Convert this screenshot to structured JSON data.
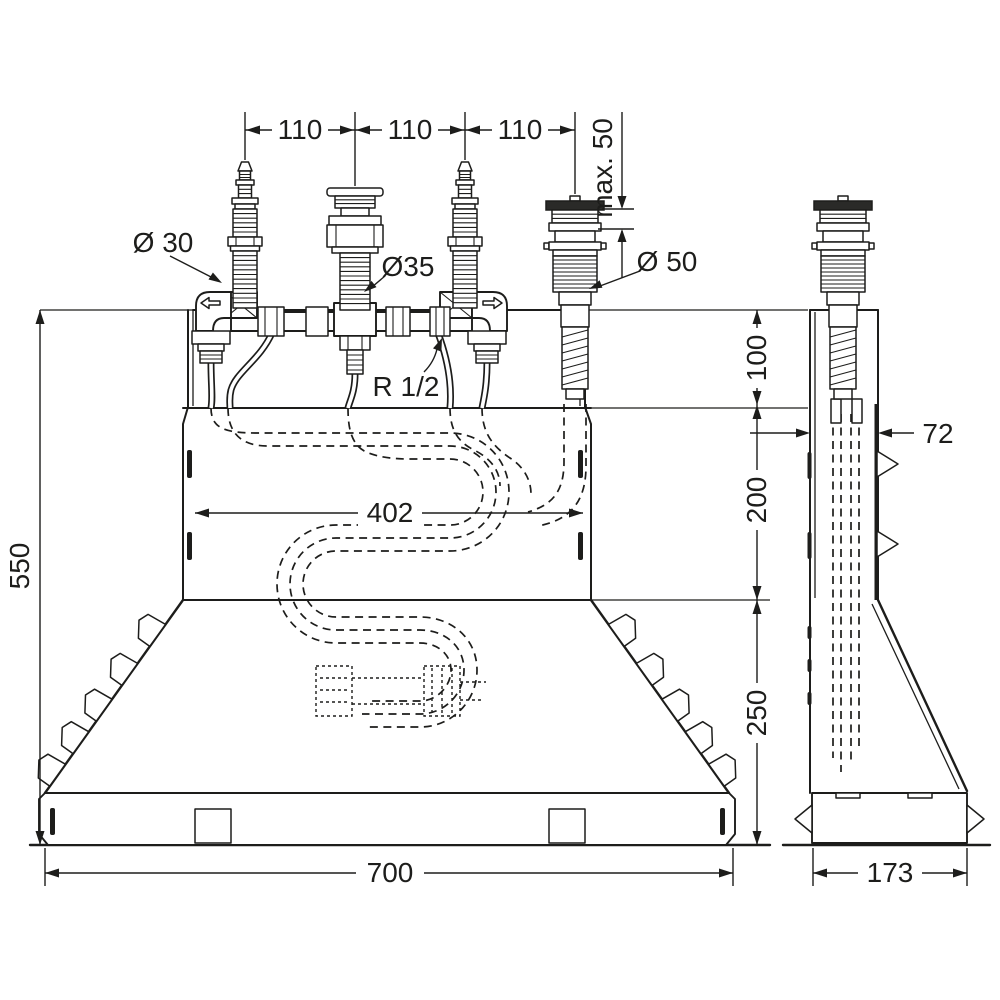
{
  "drawing": {
    "line_color": "#1d1d1b",
    "background_color": "#ffffff",
    "dims": {
      "spacing_1": "110",
      "spacing_2": "110",
      "spacing_3": "110",
      "max_mount_depth": "max. 50",
      "dia_side_valves": "Ø 30",
      "dia_center_valve": "Ø35",
      "dia_spout": "Ø 50",
      "thread_size": "R 1/2",
      "inner_width": "402",
      "total_height": "550",
      "upper_section": "100",
      "middle_section": "200",
      "lower_section": "250",
      "base_width": "700",
      "side_depth": "72",
      "side_base_width": "173"
    }
  }
}
